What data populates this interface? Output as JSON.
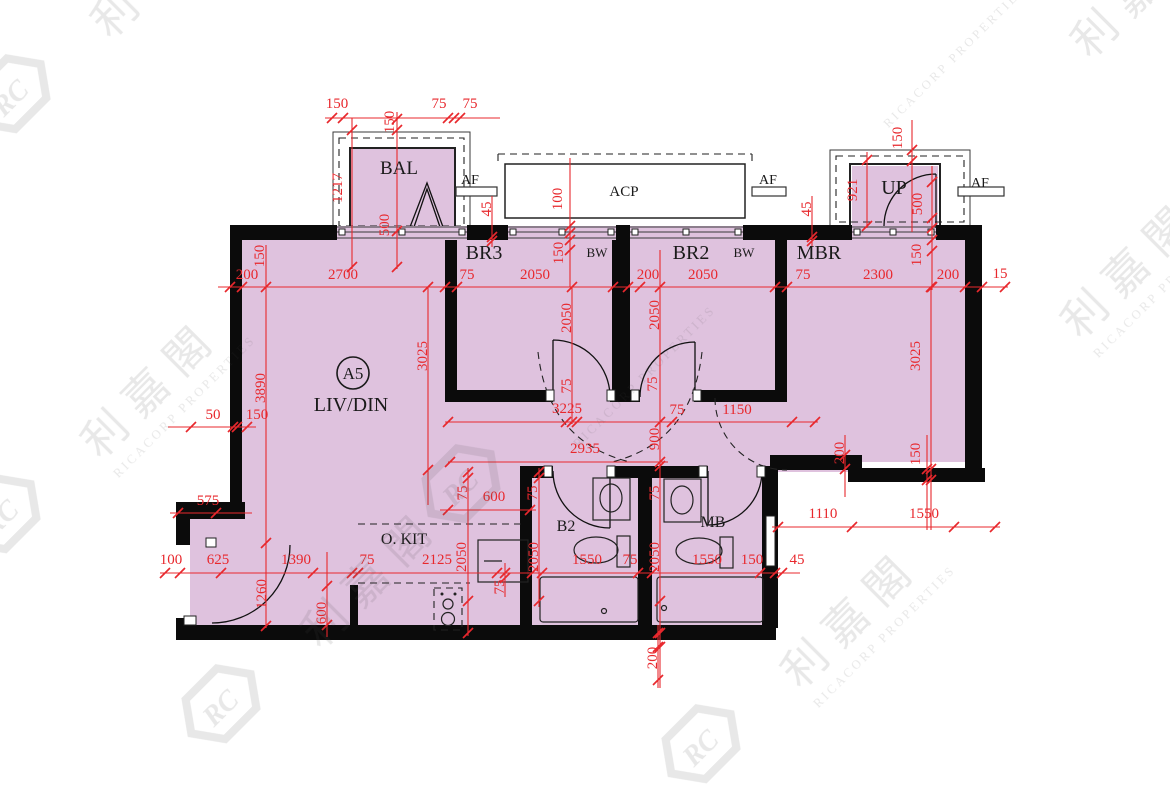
{
  "page": {
    "type": "floor-plan",
    "unit_badge": {
      "label": "A5",
      "x": 353,
      "y": 373,
      "r": 16
    }
  },
  "colors": {
    "room_fill": "#dfc2de",
    "wall": "#0b0b0b",
    "dimension": "#e8282d",
    "watermark_gray": "#4e4e4e"
  },
  "rooms": [
    {
      "t": "BAL",
      "x": 399,
      "y": 174,
      "s": 19
    },
    {
      "t": "ACP",
      "x": 624,
      "y": 196,
      "s": 15
    },
    {
      "t": "AF",
      "x": 470,
      "y": 184,
      "s": 14
    },
    {
      "t": "AF",
      "x": 768,
      "y": 184,
      "s": 14
    },
    {
      "t": "AF",
      "x": 980,
      "y": 187,
      "s": 14
    },
    {
      "t": "UP",
      "x": 894,
      "y": 194,
      "s": 20
    },
    {
      "t": "BR3",
      "x": 484,
      "y": 259,
      "s": 20
    },
    {
      "t": "BW",
      "x": 597,
      "y": 257,
      "s": 13
    },
    {
      "t": "BR2",
      "x": 691,
      "y": 259,
      "s": 20
    },
    {
      "t": "BW",
      "x": 744,
      "y": 257,
      "s": 13
    },
    {
      "t": "MBR",
      "x": 819,
      "y": 259,
      "s": 20
    },
    {
      "t": "LIV/DIN",
      "x": 351,
      "y": 411,
      "s": 20
    },
    {
      "t": "O. KIT",
      "x": 404,
      "y": 544,
      "s": 16
    },
    {
      "t": "B2",
      "x": 566,
      "y": 531,
      "s": 16
    },
    {
      "t": "MB",
      "x": 713,
      "y": 527,
      "s": 16
    }
  ],
  "dim_labels": [
    {
      "t": "150",
      "x": 337,
      "y": 108
    },
    {
      "t": "75",
      "x": 439,
      "y": 108
    },
    {
      "t": "75",
      "x": 470,
      "y": 108
    },
    {
      "t": "150",
      "x": 394,
      "y": 122,
      "v": true
    },
    {
      "t": "1217",
      "x": 342,
      "y": 188,
      "v": true
    },
    {
      "t": "500",
      "x": 389,
      "y": 225,
      "v": true
    },
    {
      "t": "45",
      "x": 491,
      "y": 209,
      "v": true
    },
    {
      "t": "100",
      "x": 562,
      "y": 199,
      "v": true
    },
    {
      "t": "150",
      "x": 563,
      "y": 253,
      "v": true
    },
    {
      "t": "150",
      "x": 902,
      "y": 138,
      "v": true
    },
    {
      "t": "921",
      "x": 857,
      "y": 190,
      "v": true
    },
    {
      "t": "500",
      "x": 922,
      "y": 204,
      "v": true
    },
    {
      "t": "45",
      "x": 811,
      "y": 209,
      "v": true
    },
    {
      "t": "150",
      "x": 264,
      "y": 256,
      "v": true
    },
    {
      "t": "200",
      "x": 247,
      "y": 279
    },
    {
      "t": "2700",
      "x": 343,
      "y": 279
    },
    {
      "t": "75",
      "x": 467,
      "y": 279
    },
    {
      "t": "2050",
      "x": 535,
      "y": 279
    },
    {
      "t": "2050",
      "x": 571,
      "y": 318,
      "v": true
    },
    {
      "t": "200",
      "x": 648,
      "y": 279
    },
    {
      "t": "2050",
      "x": 703,
      "y": 279
    },
    {
      "t": "2050",
      "x": 659,
      "y": 315,
      "v": true
    },
    {
      "t": "75",
      "x": 803,
      "y": 279
    },
    {
      "t": "2300",
      "x": 878,
      "y": 279
    },
    {
      "t": "150",
      "x": 921,
      "y": 255,
      "v": true
    },
    {
      "t": "200",
      "x": 948,
      "y": 279
    },
    {
      "t": "15",
      "x": 1000,
      "y": 278
    },
    {
      "t": "3890",
      "x": 265,
      "y": 388,
      "v": true
    },
    {
      "t": "3025",
      "x": 427,
      "y": 356,
      "v": true
    },
    {
      "t": "50",
      "x": 213,
      "y": 419
    },
    {
      "t": "150",
      "x": 257,
      "y": 419
    },
    {
      "t": "575",
      "x": 208,
      "y": 505
    },
    {
      "t": "75",
      "x": 571,
      "y": 386,
      "v": true
    },
    {
      "t": "3225",
      "x": 567,
      "y": 413
    },
    {
      "t": "75",
      "x": 657,
      "y": 384,
      "v": true
    },
    {
      "t": "75",
      "x": 677,
      "y": 414
    },
    {
      "t": "1150",
      "x": 737,
      "y": 414
    },
    {
      "t": "900",
      "x": 659,
      "y": 439,
      "v": true
    },
    {
      "t": "2935",
      "x": 585,
      "y": 453
    },
    {
      "t": "3025",
      "x": 920,
      "y": 356,
      "v": true
    },
    {
      "t": "200",
      "x": 844,
      "y": 453,
      "v": true
    },
    {
      "t": "150",
      "x": 920,
      "y": 454,
      "v": true
    },
    {
      "t": "1110",
      "x": 823,
      "y": 518
    },
    {
      "t": "1550",
      "x": 924,
      "y": 518
    },
    {
      "t": "100",
      "x": 171,
      "y": 564
    },
    {
      "t": "625",
      "x": 218,
      "y": 564
    },
    {
      "t": "1390",
      "x": 296,
      "y": 564
    },
    {
      "t": "75",
      "x": 367,
      "y": 564
    },
    {
      "t": "2125",
      "x": 437,
      "y": 564
    },
    {
      "t": "1260",
      "x": 266,
      "y": 594,
      "v": true
    },
    {
      "t": "600",
      "x": 326,
      "y": 613,
      "v": true
    },
    {
      "t": "2050",
      "x": 466,
      "y": 557,
      "v": true
    },
    {
      "t": "600",
      "x": 494,
      "y": 501
    },
    {
      "t": "75",
      "x": 467,
      "y": 493,
      "v": true
    },
    {
      "t": "75",
      "x": 537,
      "y": 493,
      "v": true
    },
    {
      "t": "2050",
      "x": 538,
      "y": 557,
      "v": true
    },
    {
      "t": "1550",
      "x": 587,
      "y": 564
    },
    {
      "t": "75",
      "x": 630,
      "y": 564
    },
    {
      "t": "75",
      "x": 504,
      "y": 587,
      "v": true
    },
    {
      "t": "75",
      "x": 659,
      "y": 493,
      "v": true
    },
    {
      "t": "2050",
      "x": 659,
      "y": 557,
      "v": true
    },
    {
      "t": "1550",
      "x": 707,
      "y": 564
    },
    {
      "t": "150",
      "x": 752,
      "y": 564
    },
    {
      "t": "45",
      "x": 797,
      "y": 564
    },
    {
      "t": "200",
      "x": 657,
      "y": 658,
      "v": true
    }
  ],
  "dim_lines": [
    [
      325,
      118,
      500,
      118
    ],
    [
      218,
      287,
      1008,
      287
    ],
    [
      168,
      427,
      256,
      427
    ],
    [
      445,
      422,
      818,
      422
    ],
    [
      448,
      462,
      668,
      462
    ],
    [
      440,
      510,
      536,
      510
    ],
    [
      170,
      513,
      252,
      513
    ],
    [
      160,
      573,
      800,
      573
    ],
    [
      772,
      527,
      1000,
      527
    ],
    [
      352,
      118,
      352,
      269
    ],
    [
      397,
      112,
      397,
      269
    ],
    [
      492,
      196,
      492,
      247
    ],
    [
      812,
      196,
      812,
      247
    ],
    [
      570,
      158,
      570,
      287
    ],
    [
      867,
      152,
      867,
      228
    ],
    [
      912,
      120,
      912,
      232
    ],
    [
      932,
      166,
      932,
      290
    ],
    [
      266,
      245,
      266,
      628
    ],
    [
      428,
      287,
      428,
      505
    ],
    [
      572,
      287,
      572,
      424
    ],
    [
      660,
      250,
      660,
      688
    ],
    [
      931,
      287,
      931,
      530
    ],
    [
      845,
      435,
      845,
      497
    ],
    [
      927,
      435,
      927,
      530
    ],
    [
      539,
      468,
      539,
      607
    ],
    [
      468,
      468,
      468,
      636
    ],
    [
      327,
      552,
      327,
      637
    ],
    [
      505,
      563,
      505,
      597
    ],
    [
      658,
      625,
      658,
      688
    ]
  ],
  "ticks": [
    [
      332,
      118
    ],
    [
      343,
      118
    ],
    [
      448,
      118
    ],
    [
      454,
      118
    ],
    [
      460,
      118
    ],
    [
      352,
      130
    ],
    [
      352,
      267
    ],
    [
      397,
      119
    ],
    [
      397,
      130
    ],
    [
      397,
      231
    ],
    [
      397,
      267
    ],
    [
      492,
      237
    ],
    [
      492,
      241
    ],
    [
      812,
      237
    ],
    [
      812,
      241
    ],
    [
      570,
      226
    ],
    [
      570,
      233
    ],
    [
      570,
      240
    ],
    [
      570,
      250
    ],
    [
      867,
      160
    ],
    [
      867,
      226
    ],
    [
      912,
      150
    ],
    [
      912,
      161
    ],
    [
      932,
      182
    ],
    [
      932,
      218
    ],
    [
      932,
      228
    ],
    [
      932,
      240
    ],
    [
      932,
      251
    ],
    [
      932,
      287
    ],
    [
      230,
      287
    ],
    [
      242,
      287
    ],
    [
      445,
      287
    ],
    [
      457,
      287
    ],
    [
      613,
      287
    ],
    [
      628,
      287
    ],
    [
      640,
      287
    ],
    [
      775,
      287
    ],
    [
      787,
      287
    ],
    [
      931,
      287
    ],
    [
      965,
      287
    ],
    [
      982,
      287
    ],
    [
      1005,
      287
    ],
    [
      191,
      427
    ],
    [
      233,
      427
    ],
    [
      237,
      427
    ],
    [
      247,
      427
    ],
    [
      266,
      287
    ],
    [
      266,
      543
    ],
    [
      266,
      626
    ],
    [
      428,
      287
    ],
    [
      428,
      470
    ],
    [
      572,
      287
    ],
    [
      572,
      422
    ],
    [
      660,
      287
    ],
    [
      660,
      422
    ],
    [
      660,
      466
    ],
    [
      660,
      601
    ],
    [
      660,
      633
    ],
    [
      660,
      647
    ],
    [
      448,
      422
    ],
    [
      566,
      422
    ],
    [
      577,
      422
    ],
    [
      672,
      422
    ],
    [
      792,
      422
    ],
    [
      815,
      422
    ],
    [
      450,
      462
    ],
    [
      660,
      462
    ],
    [
      448,
      510
    ],
    [
      530,
      510
    ],
    [
      178,
      513
    ],
    [
      216,
      513
    ],
    [
      165,
      573
    ],
    [
      180,
      573
    ],
    [
      221,
      573
    ],
    [
      313,
      573
    ],
    [
      352,
      573
    ],
    [
      358,
      573
    ],
    [
      497,
      573
    ],
    [
      532,
      573
    ],
    [
      542,
      573
    ],
    [
      638,
      573
    ],
    [
      652,
      573
    ],
    [
      760,
      573
    ],
    [
      775,
      573
    ],
    [
      782,
      573
    ],
    [
      778,
      527
    ],
    [
      852,
      527
    ],
    [
      954,
      527
    ],
    [
      995,
      527
    ],
    [
      931,
      469
    ],
    [
      931,
      480
    ],
    [
      845,
      455
    ],
    [
      845,
      469
    ],
    [
      927,
      469
    ],
    [
      927,
      480
    ],
    [
      539,
      472
    ],
    [
      539,
      478
    ],
    [
      539,
      601
    ],
    [
      468,
      472
    ],
    [
      468,
      478
    ],
    [
      468,
      601
    ],
    [
      468,
      633
    ],
    [
      327,
      586
    ],
    [
      327,
      625
    ],
    [
      505,
      573
    ],
    [
      505,
      578
    ],
    [
      658,
      633
    ],
    [
      658,
      647
    ],
    [
      658,
      680
    ]
  ],
  "watermark": {
    "cjk": "利嘉閣",
    "latin": "RICACORP PROPERTIES",
    "logo_text": "RC",
    "tiles": [
      {
        "x": 110,
        "y": 40,
        "logo": true,
        "cjk": true,
        "latin": false
      },
      {
        "x": 870,
        "y": 110,
        "logo": false,
        "cjk": false,
        "latin": true
      },
      {
        "x": 1090,
        "y": 60,
        "logo": false,
        "cjk": true,
        "latin": false
      },
      {
        "x": 1080,
        "y": 340,
        "logo": false,
        "cjk": true,
        "latin": true
      },
      {
        "x": 560,
        "y": 430,
        "logo": true,
        "cjk": false,
        "latin": true
      },
      {
        "x": 100,
        "y": 460,
        "logo": true,
        "cjk": true,
        "latin": true
      },
      {
        "x": 320,
        "y": 650,
        "logo": true,
        "cjk": true,
        "latin": false
      },
      {
        "x": 800,
        "y": 690,
        "logo": true,
        "cjk": true,
        "latin": true
      }
    ]
  }
}
